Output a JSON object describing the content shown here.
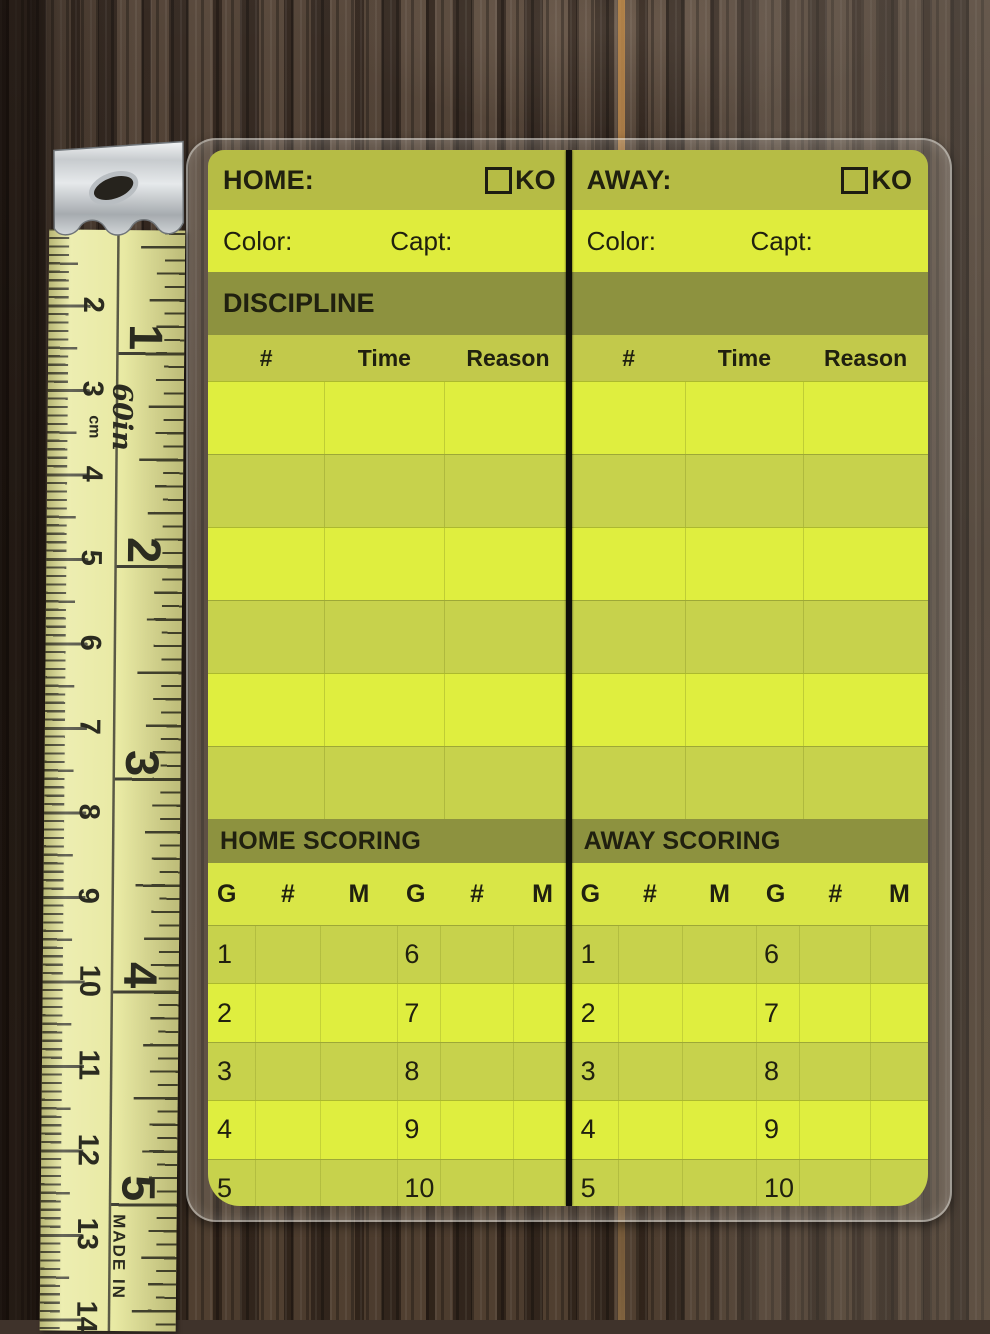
{
  "scorecard": {
    "home": {
      "title": "HOME:",
      "ko_label": "KO",
      "color_label": "Color:",
      "capt_label": "Capt:",
      "discipline_title": "DISCIPLINE",
      "scoring_title": "HOME SCORING"
    },
    "away": {
      "title": "AWAY:",
      "ko_label": "KO",
      "color_label": "Color:",
      "capt_label": "Capt:",
      "scoring_title": "AWAY SCORING"
    },
    "discipline_columns": {
      "num": "#",
      "time": "Time",
      "reason": "Reason"
    },
    "scoring_columns": {
      "goal": "G",
      "num": "#",
      "minute": "M"
    },
    "scoring_rows": [
      {
        "left_goal": "1",
        "right_goal": "6"
      },
      {
        "left_goal": "2",
        "right_goal": "7"
      },
      {
        "left_goal": "3",
        "right_goal": "8"
      },
      {
        "left_goal": "4",
        "right_goal": "9"
      },
      {
        "left_goal": "5",
        "right_goal": "10"
      }
    ]
  },
  "ruler": {
    "cm_labels": [
      "2",
      "3",
      "4",
      "5",
      "6",
      "7",
      "8",
      "9",
      "10",
      "11",
      "12",
      "13",
      "14"
    ],
    "inch_labels": [
      "1",
      "2",
      "3",
      "4",
      "5"
    ],
    "length_label": "60in",
    "unit_label": "cm",
    "made_in_label": "MADE IN"
  },
  "colors": {
    "card_bright_row": "#dfee3f",
    "card_dark_row": "#c7d24c",
    "olive_band": "#8d923f",
    "top_band": "#b6bc45",
    "column_header_band": "#c2c94b",
    "tape": "#e6e79b",
    "wood": "#43362c",
    "ink": "#20200f"
  }
}
